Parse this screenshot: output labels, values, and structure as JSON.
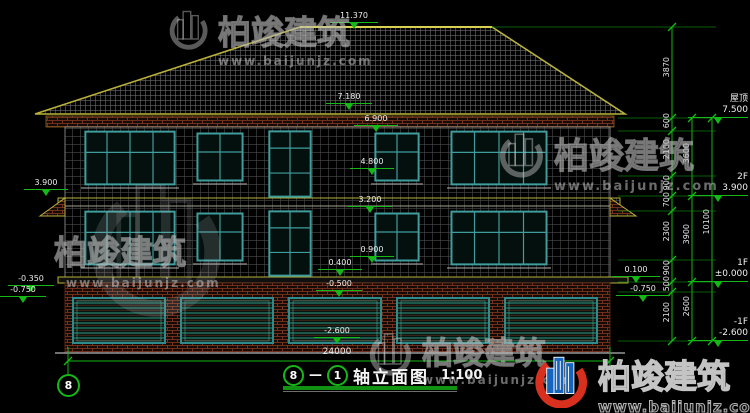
{
  "brand": {
    "name": "柏竣建筑",
    "url": "www.baijunjz.com"
  },
  "title": {
    "axis_from": "8",
    "axis_to": "1",
    "name": "轴立面图",
    "scale": "1:100"
  },
  "axis_bubble": {
    "label": "8"
  },
  "elevation_marks": {
    "ridge": "11.370",
    "eave_top": "7.180",
    "eave_bottom": "6.900",
    "sill_2f": "4.800",
    "lintel_1f": "3.200",
    "sill_1f": "0.900",
    "porch": "0.400",
    "grade_front": "-0.500",
    "garage_floor": "-2.600",
    "left_2f": "3.900",
    "left_grade_a": "-0.350",
    "left_grade_b": "-0.750",
    "right_grade_a": "0.100",
    "right_grade_b": "-0.750"
  },
  "right_dims": {
    "col1": [
      "3870",
      "600",
      "2100",
      "900",
      "700",
      "2300",
      "900",
      "500",
      "2100"
    ],
    "col2": [
      "3600",
      "3900",
      "2600"
    ],
    "col3": [
      "10100"
    ]
  },
  "right_levels": [
    {
      "label": "屋顶",
      "value": "7.500"
    },
    {
      "label": "2F",
      "value": "3.900"
    },
    {
      "label": "1F",
      "value": "±0.000"
    },
    {
      "label": "-1F",
      "value": "-2.600"
    }
  ],
  "bottom_dim": "24000",
  "colors": {
    "dim_green": "#15b915",
    "frame_teal": "#3f9d9d",
    "eave_yellow": "#b8b23a",
    "brick_red": "#8a3b22",
    "logo_red": "#d8301f",
    "logo_blue": "#1565c0"
  }
}
